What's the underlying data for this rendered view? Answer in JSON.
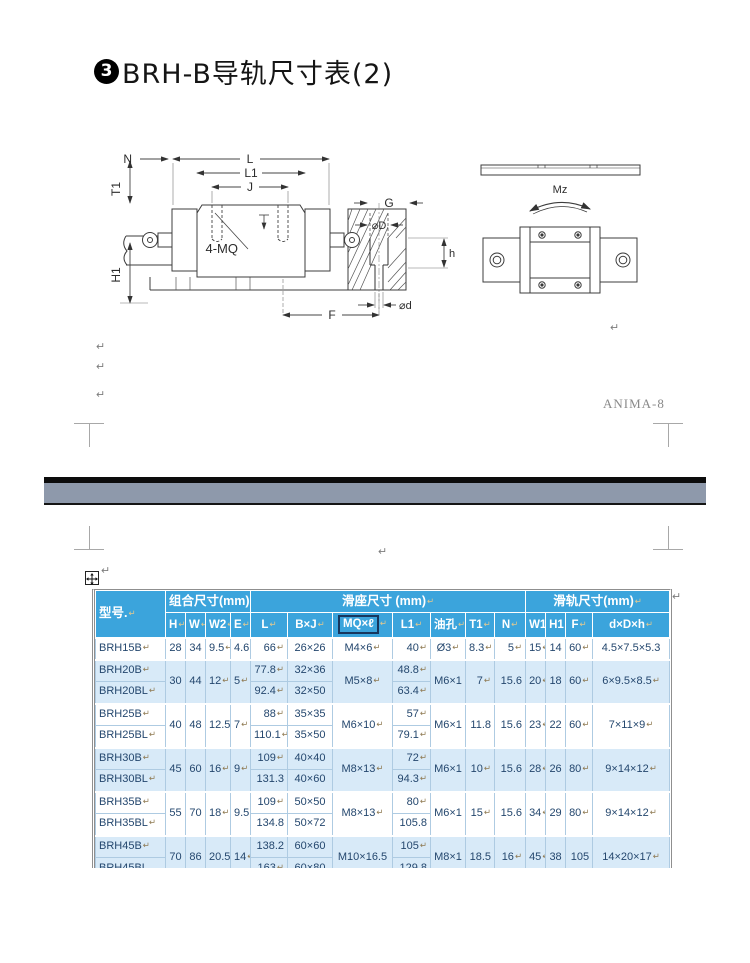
{
  "title": {
    "bullet": "3",
    "text": "BRH-B导轨尺寸表(2)"
  },
  "watermark": "ANIMA-8",
  "marks": {
    "pilcrow": "↵"
  },
  "colors": {
    "header_blue": "#3ba4dc",
    "row_blue": "#d8eaf8",
    "grid": "#aecbe2",
    "text_navy": "#24476e",
    "pagebreak_gray": "#8e99ab"
  },
  "diagram": {
    "left": {
      "N": "N",
      "L": "L",
      "L1": "L1",
      "J": "J",
      "T1": "T1",
      "H1": "H1",
      "MQ": "4-MQ",
      "G": "G",
      "D": "⌀D",
      "h": "h",
      "d": "⌀d",
      "F": "F"
    },
    "right": {
      "Mz": "Mz"
    }
  },
  "table": {
    "mark": "↵",
    "col_widths": [
      70,
      20,
      20,
      25,
      20,
      37,
      45,
      60,
      38,
      35,
      29,
      31,
      20,
      20,
      27,
      77
    ],
    "col_align": [
      "l",
      "c",
      "c",
      "r",
      "r",
      "r",
      "c",
      "c",
      "r",
      "c",
      "r",
      "r",
      "r",
      "c",
      "r",
      "c"
    ],
    "header": {
      "model": "型号.↵",
      "groups": [
        {
          "label": "组合尺寸(mm)↵",
          "span": 4
        },
        {
          "label": "滑座尺寸  (mm)↵",
          "span": 7
        },
        {
          "label": "滑轨尺寸(mm)↵",
          "span": 4
        }
      ],
      "columns": [
        "H↵",
        "W↵",
        "W2↵",
        "E↵",
        "L↵",
        "B×J↵",
        {
          "label": "MQ×ℓ",
          "boxed": true,
          "mark": true
        },
        "L1↵",
        "油孔↵",
        "T1↵",
        "N↵",
        "W1",
        "H1",
        "F↵",
        "d×D×h↵"
      ]
    },
    "groups": [
      {
        "shade": false,
        "combo": [
          "28",
          "34",
          "9.5↵",
          "4.6"
        ],
        "mq": "M4×6↵",
        "oil": "Ø3↵",
        "t1": "8.3↵",
        "n": "5↵",
        "rail": [
          "15↵",
          "14",
          "60↵",
          "4.5×7.5×5.3"
        ],
        "rows": [
          {
            "model": "BRH15B↵",
            "L": "66↵",
            "BJ": "26×26",
            "L1": "40↵"
          }
        ]
      },
      {
        "shade": true,
        "combo": [
          "30",
          "44",
          "12↵",
          "5↵"
        ],
        "mq": "M5×8↵",
        "oil": "M6×1",
        "t1": "7↵",
        "n": "15.6",
        "rail": [
          "20↵",
          "18",
          "60↵",
          "6×9.5×8.5↵"
        ],
        "rows": [
          {
            "model": "BRH20B↵",
            "L": "77.8↵",
            "BJ": "32×36",
            "L1": "48.8↵"
          },
          {
            "model": "BRH20BL↵",
            "L": "92.4↵",
            "BJ": "32×50",
            "L1": "63.4↵"
          }
        ]
      },
      {
        "shade": false,
        "combo": [
          "40",
          "48",
          "12.5",
          "7↵"
        ],
        "mq": "M6×10↵",
        "oil": "M6×1",
        "t1": "11.8",
        "n": "15.6",
        "rail": [
          "23↵",
          "22",
          "60↵",
          "7×11×9↵"
        ],
        "rows": [
          {
            "model": "BRH25B↵",
            "L": "88↵",
            "BJ": "35×35",
            "L1": "57↵"
          },
          {
            "model": "BRH25BL↵",
            "L": "110.1↵",
            "BJ": "35×50",
            "L1": "79.1↵"
          }
        ]
      },
      {
        "shade": true,
        "combo": [
          "45",
          "60",
          "16↵",
          "9↵"
        ],
        "mq": "M8×13↵",
        "oil": "M6×1",
        "t1": "10↵",
        "n": "15.6",
        "rail": [
          "28↵",
          "26",
          "80↵",
          "9×14×12↵"
        ],
        "rows": [
          {
            "model": "BRH30B↵",
            "L": "109↵",
            "BJ": "40×40",
            "L1": "72↵"
          },
          {
            "model": "BRH30BL↵",
            "L": "131.3",
            "BJ": "40×60",
            "L1": "94.3↵"
          }
        ]
      },
      {
        "shade": false,
        "combo": [
          "55",
          "70",
          "18↵",
          "9.5"
        ],
        "mq": "M8×13↵",
        "oil": "M6×1",
        "t1": "15↵",
        "n": "15.6",
        "rail": [
          "34↵",
          "29",
          "80↵",
          "9×14×12↵"
        ],
        "rows": [
          {
            "model": "BRH35B↵",
            "L": "109↵",
            "BJ": "50×50",
            "L1": "80↵"
          },
          {
            "model": "BRH35BL↵",
            "L": "134.8",
            "BJ": "50×72",
            "L1": "105.8"
          }
        ]
      },
      {
        "shade": true,
        "combo": [
          "70",
          "86",
          "20.5",
          "14↵"
        ],
        "mq": "M10×16.5",
        "oil": "M8×1",
        "t1": "18.5",
        "n": "16↵",
        "rail": [
          "45↵",
          "38",
          "105",
          "14×20×17↵"
        ],
        "rows": [
          {
            "model": "BRH45B↵",
            "L": "138.2",
            "BJ": "60×60",
            "L1": "105↵"
          },
          {
            "model": "BRH45BL",
            "L": "163↵",
            "BJ": "60×80",
            "L1": "129.8"
          }
        ]
      }
    ]
  }
}
